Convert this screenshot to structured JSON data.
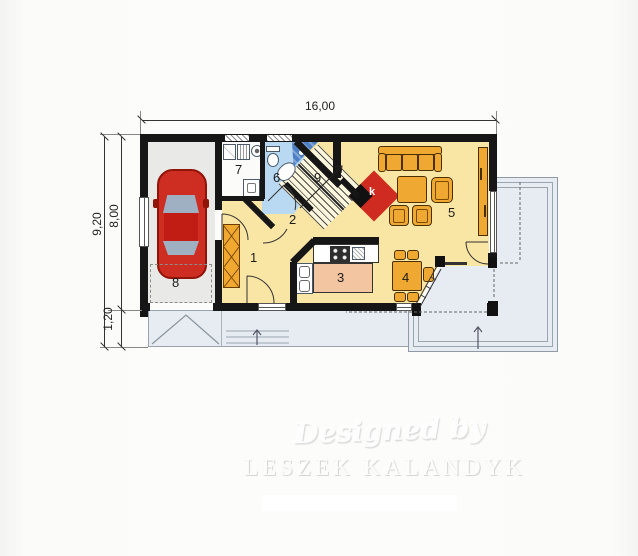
{
  "plan": {
    "title_note": "single storey house floor plan",
    "dimensions": {
      "width_label": "16,00",
      "height_total_label": "9,20",
      "height_main_label": "8,00",
      "height_lower_label": "1,20"
    },
    "rooms": {
      "r1": "1",
      "r2": "2",
      "r3": "3",
      "r4": "4",
      "r5": "5",
      "r6": "6",
      "r7": "7",
      "r8": "8",
      "r9": "9"
    },
    "fireplace_label": "k",
    "watermark": {
      "line1": "Designed by",
      "line2": "LESZEK KALANDYK"
    },
    "colors": {
      "wall": "#161616",
      "floor_main": "#fae6a4",
      "floor_bath": "#b9d8f1",
      "floor_garage": "#e9e9e7",
      "terrace": "#e6ecf2",
      "furniture_orange": "#efa933",
      "kitchen_island": "#f3c6a1",
      "fireplace_red": "#cf2b20",
      "car_red": "#ce2d22",
      "shower_blue": "#4d80c4"
    }
  }
}
